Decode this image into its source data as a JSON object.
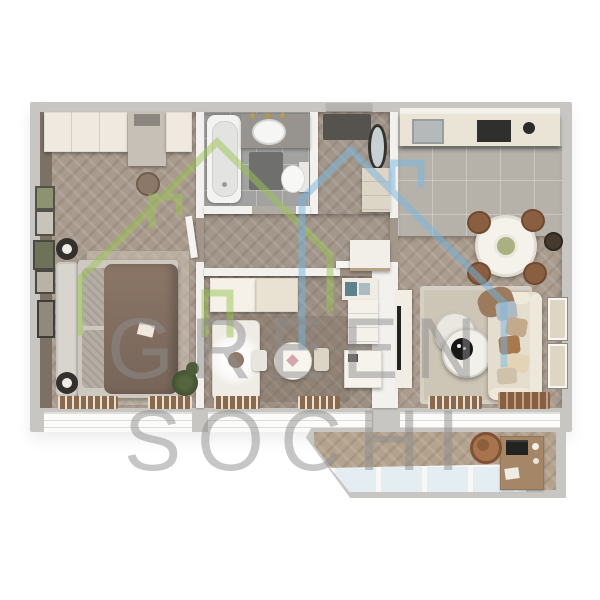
{
  "watermark": {
    "line1": "GREEN",
    "line2": "SOCHI",
    "text_color": "#8e8e8e",
    "logo": {
      "green_house_color": "#9cc557",
      "blue_house_color": "#76b6e1"
    }
  },
  "palette": {
    "background": "#ffffff",
    "outer_wall": "#c8c6c3",
    "inner_wall": "#f3f1ee",
    "wood_floor": "#a79a8c",
    "tile_floor": "#a2a2a0",
    "kitchen_tile": "#b6b2aa",
    "bed_duvet": "#84705f",
    "sofa": "#e5dece",
    "rug": "#cdc5b6",
    "radiator_slats": "#8a6a4e",
    "balcony_glass": "#e3edf2"
  }
}
